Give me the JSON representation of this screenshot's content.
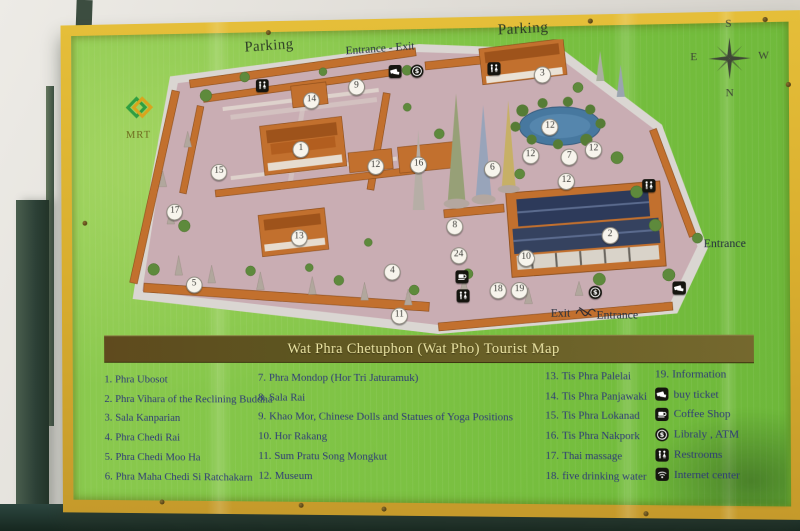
{
  "photo": {
    "sign": {
      "title": "Wat Phra Chetuphon (Wat Pho) Tourist Map",
      "labels": {
        "parking_left": "Parking",
        "entrance_exit_top": "Entrance - Exit",
        "parking_right": "Parking",
        "mrt": "MRT",
        "entrance_right": "Entrance",
        "exit_bottom": "Exit",
        "entrance_bottom": "Entrance"
      },
      "compass": {
        "top": "S",
        "left": "E",
        "right": "W",
        "bottom": "N"
      },
      "colors": {
        "board_green": "#7ec344",
        "frame_yellow": "#d9ae2e",
        "banner_brown": "#5e511f",
        "banner_text": "#ece5a4",
        "legend_text": "#2e3a78",
        "map_ground": "#c9adb3",
        "building_orange": "#c2702e",
        "roof_navy": "#2d3a5a",
        "pond_blue": "#47789f"
      },
      "markers": [
        {
          "n": "1",
          "x": 31.5,
          "y": 36
        },
        {
          "n": "2",
          "x": 82.1,
          "y": 66
        },
        {
          "n": "3",
          "x": 71.3,
          "y": 12
        },
        {
          "n": "4",
          "x": 46.6,
          "y": 78
        },
        {
          "n": "5",
          "x": 13.4,
          "y": 82
        },
        {
          "n": "6",
          "x": 63.1,
          "y": 43.4
        },
        {
          "n": "7",
          "x": 75.6,
          "y": 39.7
        },
        {
          "n": "8",
          "x": 56.9,
          "y": 62.7
        },
        {
          "n": "9",
          "x": 40.8,
          "y": 14.9
        },
        {
          "n": "10",
          "x": 68.5,
          "y": 73.6
        },
        {
          "n": "11",
          "x": 47.7,
          "y": 92.9
        },
        {
          "n": "12",
          "x": 43.9,
          "y": 42
        },
        {
          "n": "12",
          "x": 72.5,
          "y": 29.5
        },
        {
          "n": "12",
          "x": 69.3,
          "y": 39
        },
        {
          "n": "12",
          "x": 79.5,
          "y": 37.3
        },
        {
          "n": "12",
          "x": 75.1,
          "y": 47.8
        },
        {
          "n": "13",
          "x": 31.1,
          "y": 66.1
        },
        {
          "n": "14",
          "x": 33.3,
          "y": 19.3
        },
        {
          "n": "15",
          "x": 17.7,
          "y": 43.4
        },
        {
          "n": "16",
          "x": 51,
          "y": 41.7
        },
        {
          "n": "17",
          "x": 10.2,
          "y": 57
        },
        {
          "n": "18",
          "x": 63.9,
          "y": 84.4
        },
        {
          "n": "19",
          "x": 67.4,
          "y": 84.4
        },
        {
          "n": "24",
          "x": 57.5,
          "y": 72.5
        }
      ],
      "map_icons": [
        {
          "icon": "restroom-icon",
          "x": 25.1,
          "y": 13.9
        },
        {
          "icon": "ticket-icon",
          "x": 47.2,
          "y": 9.8
        },
        {
          "icon": "atm-icon",
          "x": 50.8,
          "y": 9.8
        },
        {
          "icon": "restroom-icon",
          "x": 63.4,
          "y": 9.5
        },
        {
          "icon": "restroom-icon",
          "x": 88.4,
          "y": 49.5
        },
        {
          "icon": "coffee-icon",
          "x": 58,
          "y": 79.7
        },
        {
          "icon": "restroom-icon",
          "x": 58.2,
          "y": 86.1
        },
        {
          "icon": "atm-icon",
          "x": 79.7,
          "y": 85.1
        },
        {
          "icon": "ticket-icon",
          "x": 93.1,
          "y": 83.7
        }
      ],
      "legend": {
        "columns": [
          {
            "items": [
              {
                "num": "1.",
                "label": "Phra Ubosot"
              },
              {
                "num": "2.",
                "label": "Phra Vihara of the Reclining Buddha"
              },
              {
                "num": "3.",
                "label": "Sala Kanparian"
              },
              {
                "num": "4.",
                "label": "Phra Chedi Rai"
              },
              {
                "num": "5.",
                "label": "Phra Chedi Moo Ha"
              },
              {
                "num": "6.",
                "label": "Phra Maha Chedi Si Ratchakarn"
              }
            ]
          },
          {
            "items": [
              {
                "num": "7.",
                "label": "Phra Mondop (Hor Tri Jaturamuk)"
              },
              {
                "num": "8.",
                "label": "Sala Rai"
              },
              {
                "num": "9.",
                "label": "Khao Mor, Chinese Dolls and Statues of Yoga Positions"
              },
              {
                "num": "10.",
                "label": "Hor Rakang"
              },
              {
                "num": "11.",
                "label": "Sum Pratu Song Mongkut"
              },
              {
                "num": "12.",
                "label": "Museum"
              }
            ]
          },
          {
            "items": [
              {
                "num": "13.",
                "label": "Tis Phra Palelai"
              },
              {
                "num": "14.",
                "label": "Tis Phra Panjawaki"
              },
              {
                "num": "15.",
                "label": "Tis Phra Lokanad"
              },
              {
                "num": "16.",
                "label": "Tis Phra Nakpork"
              },
              {
                "num": "17.",
                "label": "Thai massage"
              },
              {
                "num": "18.",
                "label": "five drinking water"
              }
            ]
          },
          {
            "items": [
              {
                "num": "19.",
                "label": "Information"
              },
              {
                "icon": "ticket-icon",
                "label": "buy ticket"
              },
              {
                "icon": "coffee-icon",
                "label": "Coffee Shop"
              },
              {
                "icon": "atm-icon",
                "label": "Libraly , ATM"
              },
              {
                "icon": "restroom-icon",
                "label": "Restrooms"
              },
              {
                "icon": "wifi-icon",
                "label": "Internet center"
              }
            ]
          }
        ]
      }
    }
  }
}
